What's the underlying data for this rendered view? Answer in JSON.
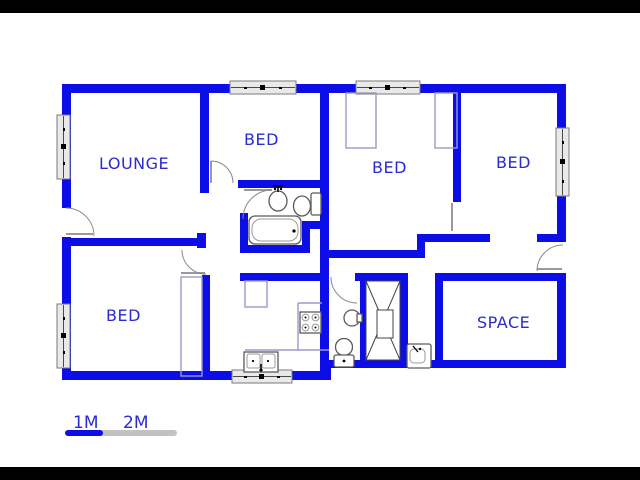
{
  "plan": {
    "type": "house-floor-plan",
    "rooms": [
      {
        "id": "lounge",
        "label": "LOUNGE"
      },
      {
        "id": "bed-top-middle",
        "label": "BED"
      },
      {
        "id": "bed-middle",
        "label": "BED"
      },
      {
        "id": "bed-top-right",
        "label": "BED"
      },
      {
        "id": "bed-bottom-left",
        "label": "BED"
      },
      {
        "id": "space",
        "label": "SPACE"
      }
    ],
    "fixtures": [
      "bathtub",
      "wash-basin",
      "toilet",
      "hand-basin",
      "second-toilet",
      "shower",
      "vanity-basin",
      "kitchen-sink",
      "stove",
      "wardrobe",
      "cupboard"
    ],
    "openings": {
      "windows": 6,
      "door-swings": 6
    }
  },
  "scale_bar": {
    "labels": [
      "1M",
      "2M"
    ]
  },
  "colors": {
    "wall": "#0d0de8",
    "label": "#2b2bd0",
    "gray": "#c2c2c2",
    "outline": "#5a5a5a",
    "counter": "#9a9ac8",
    "winfill": "#e9e9e9",
    "winborder": "#7a7a7a",
    "bg": "#ffffff",
    "letterbox": "#000000"
  }
}
